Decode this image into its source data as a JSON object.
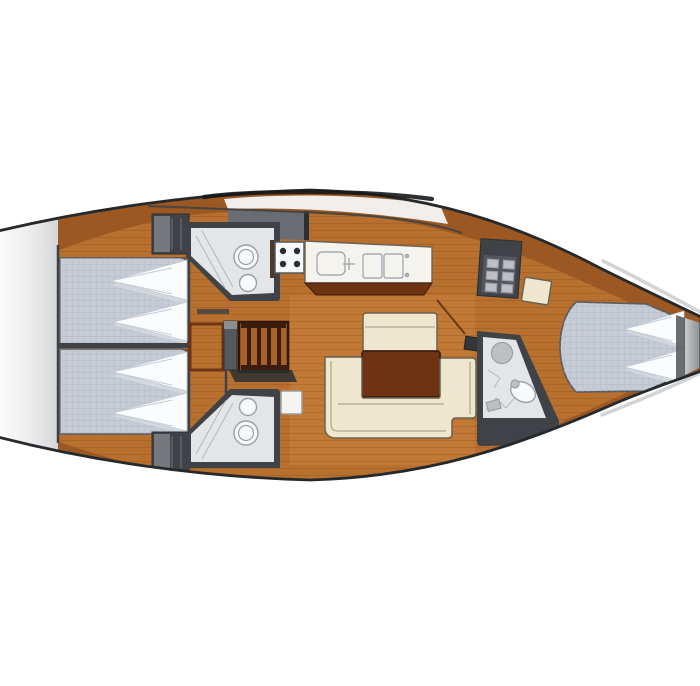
{
  "diagram": {
    "type": "yacht-interior-floor-plan",
    "orientation": {
      "bow": "right",
      "stern": "left"
    }
  },
  "colors": {
    "bg": "#ffffff",
    "hull_stroke": "#26292c",
    "deck": "#9b5822",
    "deck_dark": "#8a4a1d",
    "floor": "#b8702f",
    "floor_light": "#c9823c",
    "plank": "#7d4416",
    "wood_dark": "#6e3312",
    "wood_frame": "#3a1d0c",
    "wall": "#3f4246",
    "wall_light": "#75797e",
    "hatch_gray": "#696d71",
    "bed": "#c6ccd6",
    "bed_grid": "#aeb5c1",
    "bed_edge": "#565b63",
    "pillow": "#fbfcfe",
    "pillow_shadow": "#d3d7de",
    "pillow_crease": "#c4cad4",
    "cream": "#efe7cd",
    "cream_line": "#6b6252",
    "head_floor": "#e3e5e8",
    "fixture": "#f8f9fa",
    "fixture_line": "#9aa0a8",
    "white_deck": "#f7f7f7",
    "transom_from": "#ffffff",
    "transom_to": "#d5d6d8",
    "steel": "#bdc0c3",
    "shadow_dark": "#2c2f32",
    "arc": "#17191b"
  },
  "areas": {
    "hull": {
      "label": "Sailboat hull outline, bow to the right"
    },
    "transom": {
      "label": "Stern transom and swim platform"
    },
    "aft_cabin_port": {
      "label": "Aft double berth cabin (port)"
    },
    "aft_cabin_starboard": {
      "label": "Aft double berth cabin (starboard)"
    },
    "wardrobe_port": {
      "label": "Hanging locker (port)"
    },
    "wardrobe_starboard": {
      "label": "Hanging locker (starboard)"
    },
    "aft_head_port": {
      "label": "Aft head with toilet and basin (port)"
    },
    "aft_head_starboard": {
      "label": "Aft head with toilet and basin (starboard)"
    },
    "companionway": {
      "label": "Companionway steps"
    },
    "chart_table": {
      "label": "Chart table"
    },
    "cockpit_hatch": {
      "label": "Companionway sliding hatch"
    },
    "galley": {
      "label": "Galley with stove and twin sinks"
    },
    "stove": {
      "label": "Four-burner stove"
    },
    "fridge": {
      "label": "Galley locker / refrigerator"
    },
    "salon": {
      "label": "Saloon with U-shaped settee"
    },
    "salon_table": {
      "label": "Saloon table"
    },
    "salon_backrest": {
      "label": "Saloon bench seat"
    },
    "forward_head": {
      "label": "Forward head with shower"
    },
    "forward_cabin": {
      "label": "Forward V-berth cabin"
    },
    "bow": {
      "label": "Bow anchor locker"
    }
  }
}
